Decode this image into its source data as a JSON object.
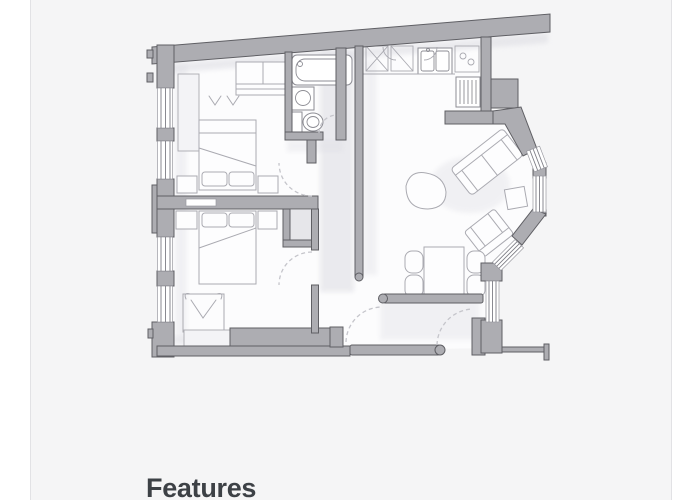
{
  "card": {
    "background": "#f5f5f6",
    "border_color": "#e2e2e5"
  },
  "features": {
    "heading": "Features"
  },
  "floorplan": {
    "kind": "apartment-floor-plan",
    "rooms_depicted": "two bedrooms, bathroom, hallway, open-plan kitchen and living-dining room with angled bay windows"
  },
  "colors": {
    "page_bg": "#ffffff",
    "card_bg": "#f5f5f6",
    "card_border": "#e2e2e5",
    "wall_fill": "#adadb2",
    "wall_stroke": "#5f5f64",
    "floor": "#fcfcfd",
    "shadow_col": "#dcdce2",
    "furniture_stroke": "#aaaab1",
    "fixture_stroke": "#8d8d94",
    "window_frame": "#9a9aa1",
    "window_line": "#7e7e86",
    "door_arc": "#c5c5cb",
    "heading": "#3d4146"
  }
}
